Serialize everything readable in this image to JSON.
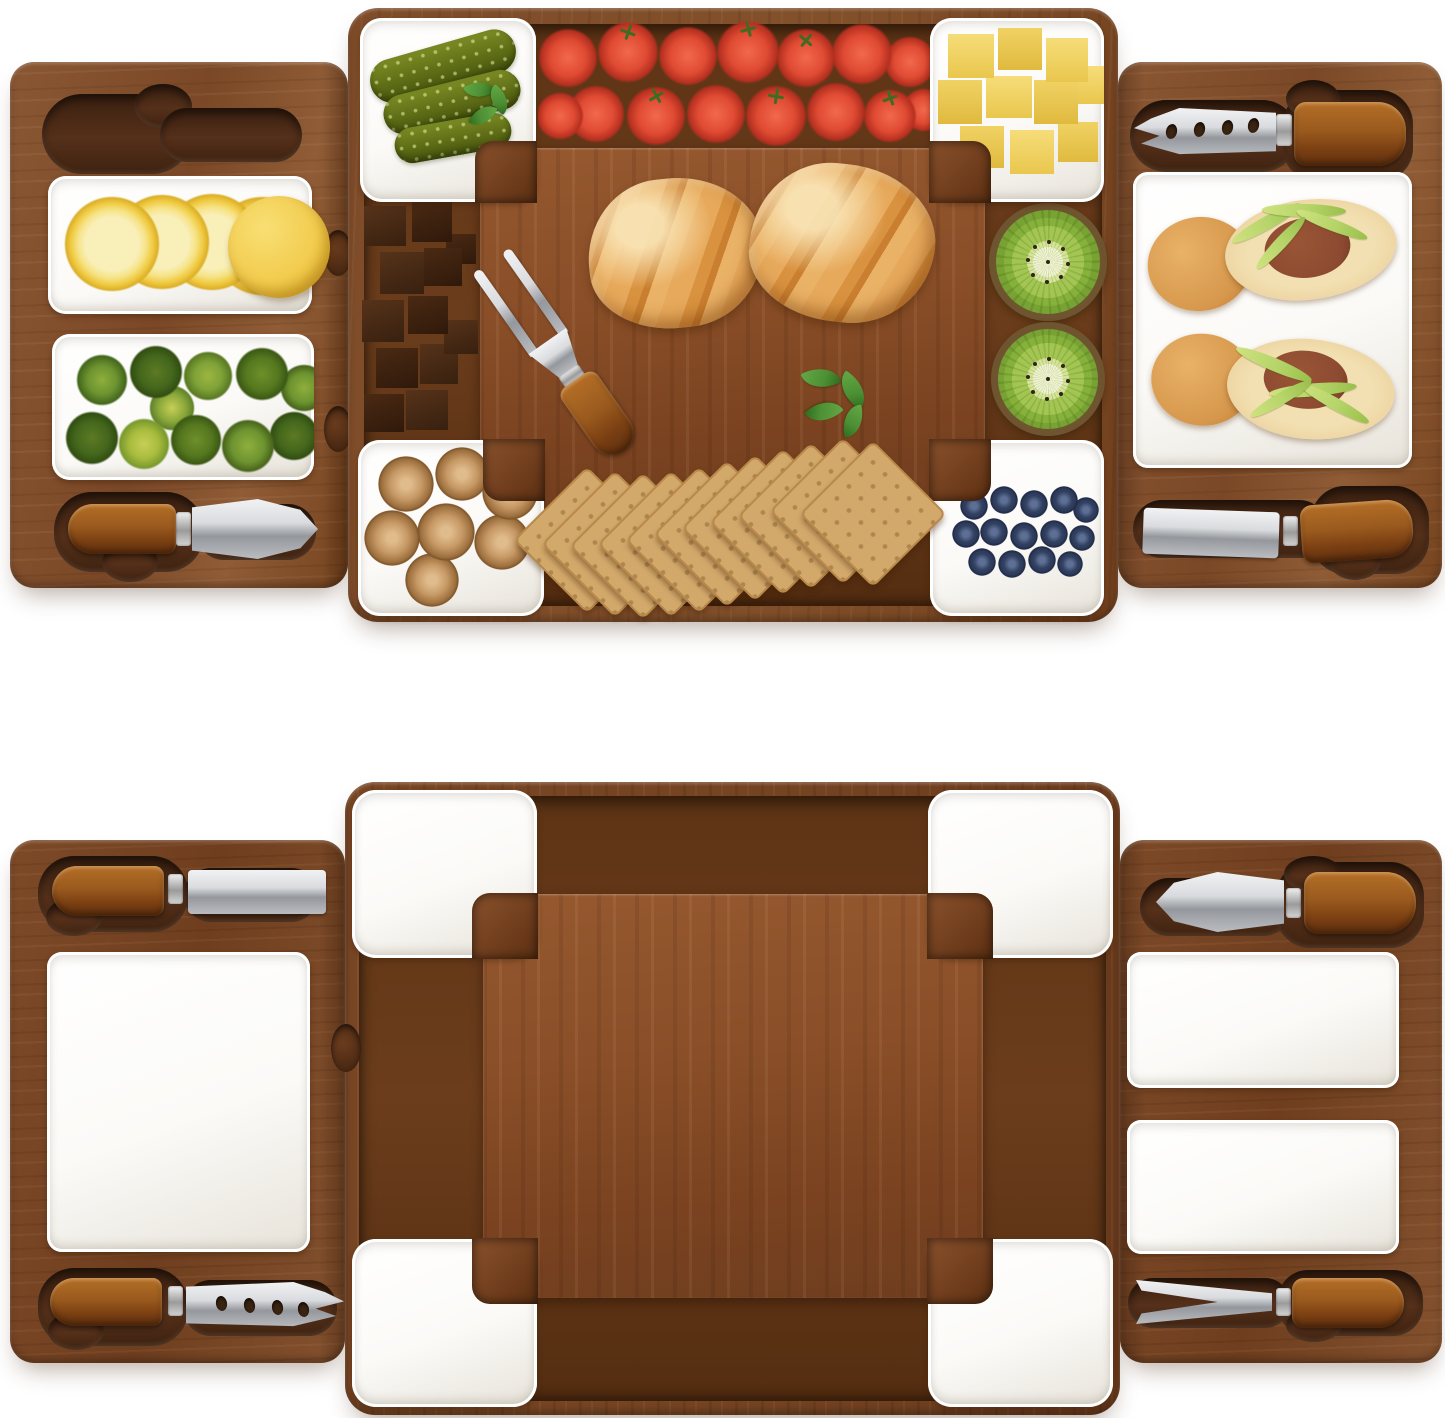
{
  "image": {
    "kind": "product photograph, two stacked views on white background",
    "subject": "Acacia wood charcuterie and cheese board set with two slide-out side trays, white ceramic dishes and stainless-steel cheese knives",
    "materials": [
      "acacia wood",
      "white ceramic",
      "stainless steel",
      "wood-handled cutlery"
    ],
    "views": {
      "loaded": {
        "label": "Top view: board set fully loaded with food",
        "left_tray": {
          "empty_knife_slot": "empty carved knife slot",
          "lemon_tray": {
            "item": "lemon slices with one half lemon",
            "count": 5
          },
          "lime_tray": {
            "item": "key limes",
            "count": 11
          },
          "knife_bottom": "spade cheese knife with wood handle"
        },
        "center_board": {
          "corner_dishes": {
            "top_left": {
              "item": "gherkin pickles with mint",
              "count": 3
            },
            "top_right": {
              "item": "cheese cubes",
              "count": 10
            },
            "bottom_left": {
              "item": "walnuts",
              "count": 7
            },
            "bottom_right": {
              "item": "blueberries",
              "count": 14
            }
          },
          "top_channel": {
            "item": "cherry tomatoes on the vine",
            "count": 15
          },
          "left_channel": {
            "item": "dark chocolate chunks",
            "count": 12
          },
          "right_channel": {
            "item": "kiwi halves",
            "count": 2
          },
          "cutting_board": {
            "items": [
              "croissant",
              "croissant",
              "two-tine cheese fork",
              "mint sprig"
            ]
          },
          "bottom_channel": {
            "item": "fanned square crackers",
            "count": 11
          }
        },
        "right_tray": {
          "knife_top": "pronged cheese knife with holes",
          "plate": {
            "item": "open baguette sandwiches with salami and frisee",
            "count": 2
          },
          "knife_bottom": "flat cheese spreader"
        }
      },
      "empty": {
        "label": "Bottom view: empty board set",
        "left_tray": {
          "knife_top": "flat cheese spreader",
          "plate": "large square ceramic plate",
          "knife_bottom": "pronged cheese knife with holes"
        },
        "center_board": {
          "corner_dishes": "four L-shaped white ceramic corner dishes",
          "cutting_board": "raised acacia cutting surface with surrounding channel"
        },
        "right_tray": {
          "knife_top": "spade cheese knife",
          "tray_upper": "rectangular ceramic tray",
          "tray_lower": "rectangular ceramic tray",
          "fork_bottom": "two-tine cheese fork"
        }
      }
    },
    "colors": null
  },
  "colors": {
    "wood-wing": "#8a5733",
    "wood-wing-2": "#76441f",
    "wood-center": "#82502b",
    "wood-center-bottom": "#744322",
    "wood-channel": "#5e3415",
    "wood-raised": "#8a4f28",
    "wood-recess": "#3f2310",
    "ceramic": "#fbfaf7",
    "ceramic-shade": "#e7e3da",
    "steel": "#d9dbde",
    "steel-dark": "#94979c",
    "handle": "#9a5a1e",
    "handle-dark": "#5f3110",
    "tomato": "#df4a32",
    "tomato-dark": "#b63020",
    "stem": "#3f6b22",
    "lemon-rind": "#efc93f",
    "lemon-flesh": "#f6e283",
    "lemon-core": "#f9efb8",
    "lime": "#6d9430",
    "lime-dark": "#44671c",
    "lime-light": "#a9bc3e",
    "pickle": "#5d6c15",
    "pickle-dark": "#47540f",
    "cheese": "#f2d464",
    "cheese-dark": "#e3bb3f",
    "chocolate": "#38200f",
    "chocolate-light": "#56331a",
    "croissant": "#e7a95b",
    "croissant-dark": "#c97f2f",
    "croissant-light": "#f6ddae",
    "kiwi": "#86b23b",
    "kiwi-core": "#eef3cf",
    "kiwi-rind": "#6f5430",
    "walnut": "#c79a66",
    "walnut-dark": "#9c6f3e",
    "cracker": "#d3a96b",
    "cracker-dark": "#b8894a",
    "blueberry": "#2e3c5e",
    "blueberry-light": "#5d6f95",
    "mint": "#4d8f34",
    "mint-dark": "#2f6b1e",
    "bread-crust": "#d6974c",
    "bread-crumb": "#eed6a4",
    "salami": "#8c4a31",
    "frisee": "#b5d469"
  }
}
